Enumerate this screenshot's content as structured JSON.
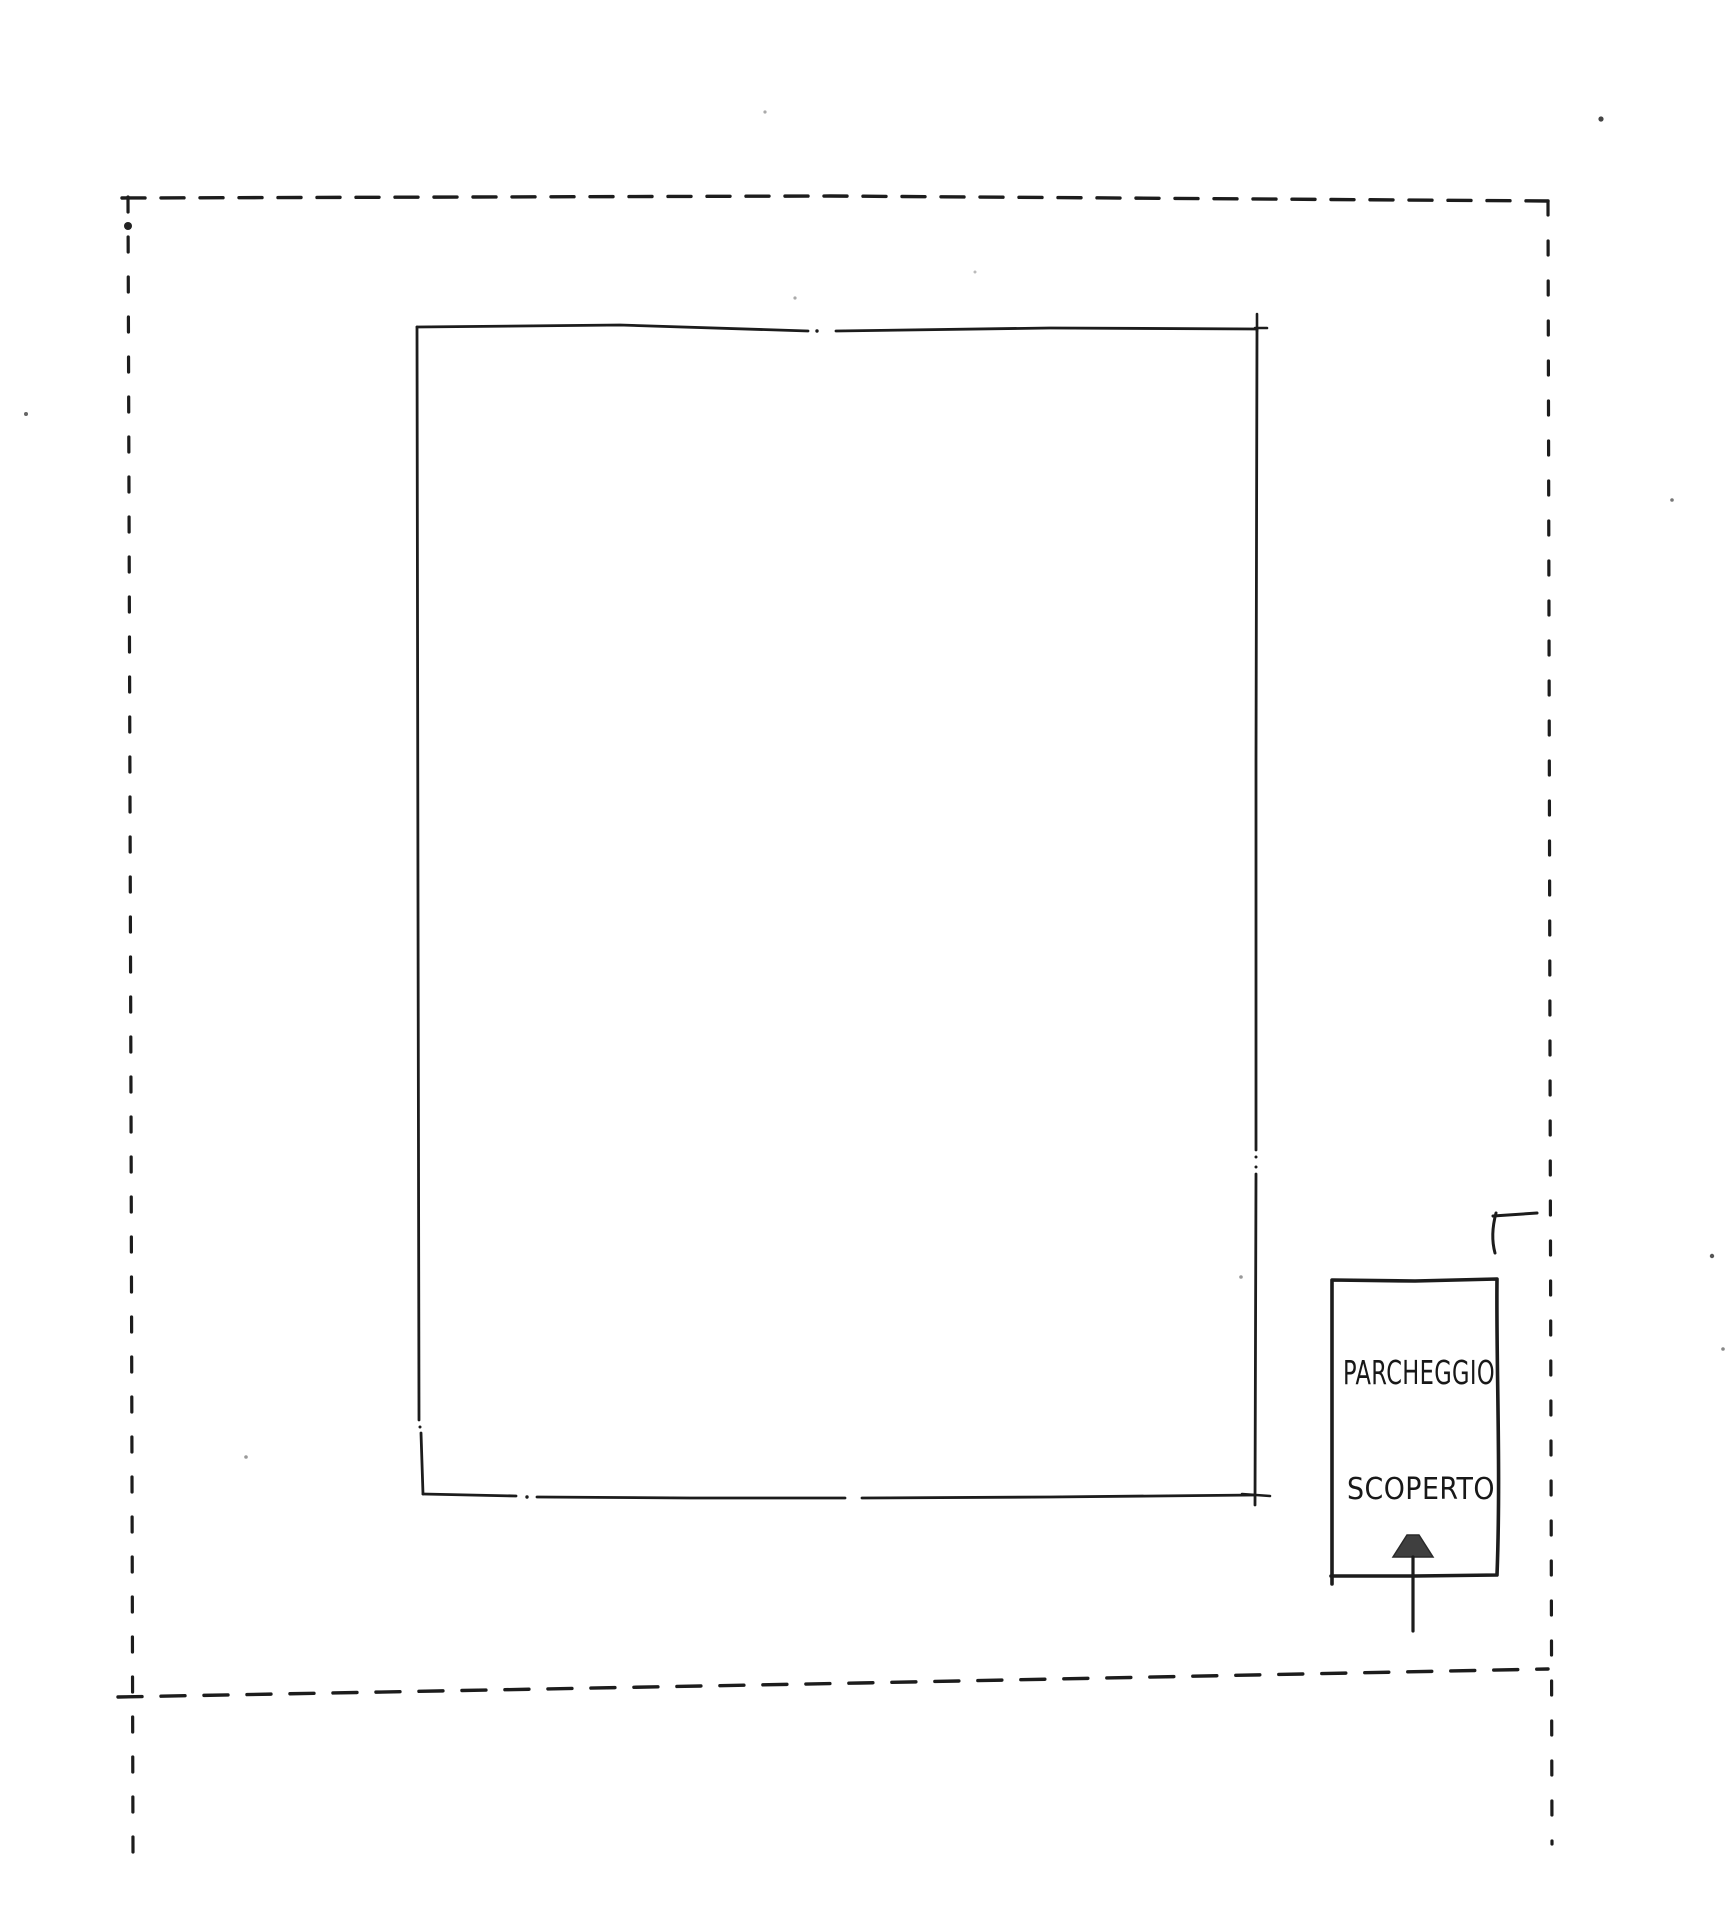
{
  "paper": {
    "background_color": "#ffffff",
    "ink_color": "#1c1c1c"
  },
  "parking_stall": {
    "label_line1": "PARCHEGGIO",
    "label_line2": "SCOPERTO",
    "arrow_fill": "#3f3f3f"
  }
}
